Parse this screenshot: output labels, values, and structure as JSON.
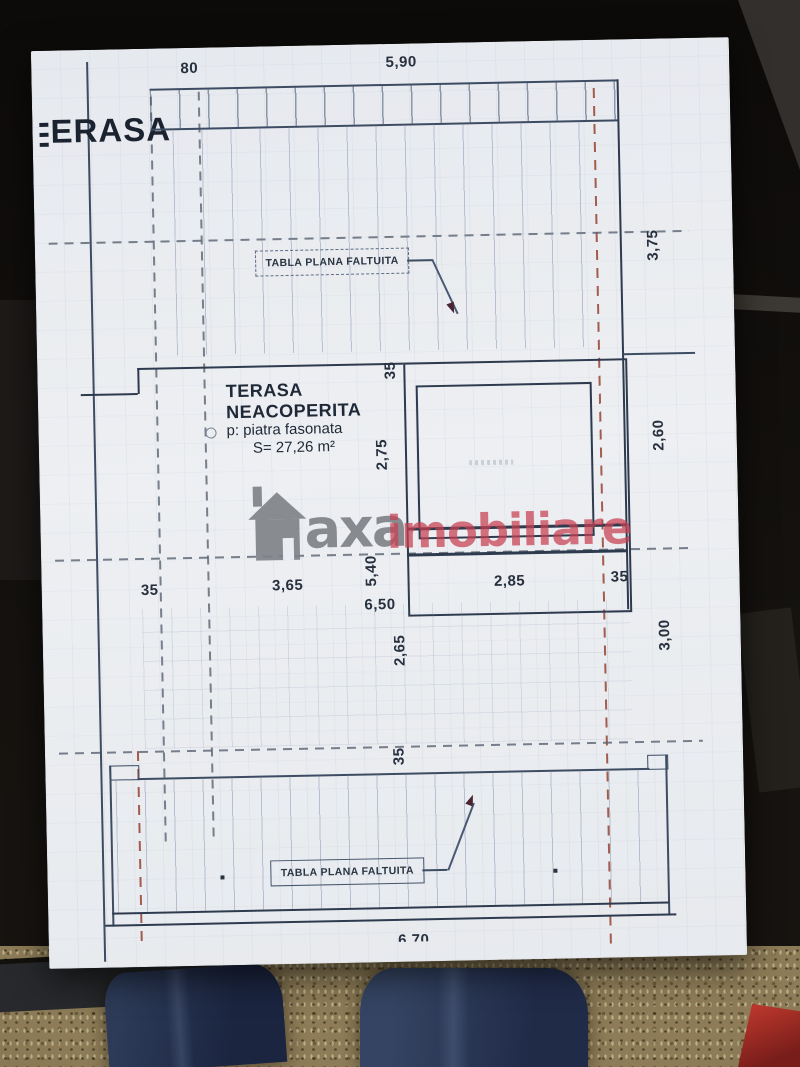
{
  "watermark": {
    "gray_text": "axa",
    "red_text": "imobiliare"
  },
  "plan": {
    "corner_title": "ERASA",
    "top_roof_label": "TABLA PLANA FALTUITA",
    "bottom_roof_label": "TABLA PLANA FALTUITA",
    "terrace": {
      "name_line1": "TERASA",
      "name_line2": "NEACOPERITA",
      "finish": "p: piatra fasonata",
      "area": "S= 27,26 m²"
    },
    "dims": {
      "top_left": "80",
      "top_width": "5,90",
      "right_upper": "3,75",
      "right_middle": "2,60",
      "right_lower": "3,00",
      "wall_top": "35",
      "wall_bottom": "35",
      "row_left_wall": "35",
      "row_span_left": "3,65",
      "row_span_right": "2,85",
      "row_right_wall": "35",
      "terrace_depth": "2,75",
      "terrace_height": "5,40",
      "terrace_total": "6,50",
      "lower_depth": "2,65",
      "bottom_total": "6,70"
    },
    "colors": {
      "paper": "#e9ecf0",
      "ink": "#2e3a4e",
      "axis_gray": "#58626f",
      "axis_red": "#96422f",
      "text": "#27303e",
      "watermark_gray": "#7c7f85",
      "watermark_red": "#c73e50"
    }
  }
}
